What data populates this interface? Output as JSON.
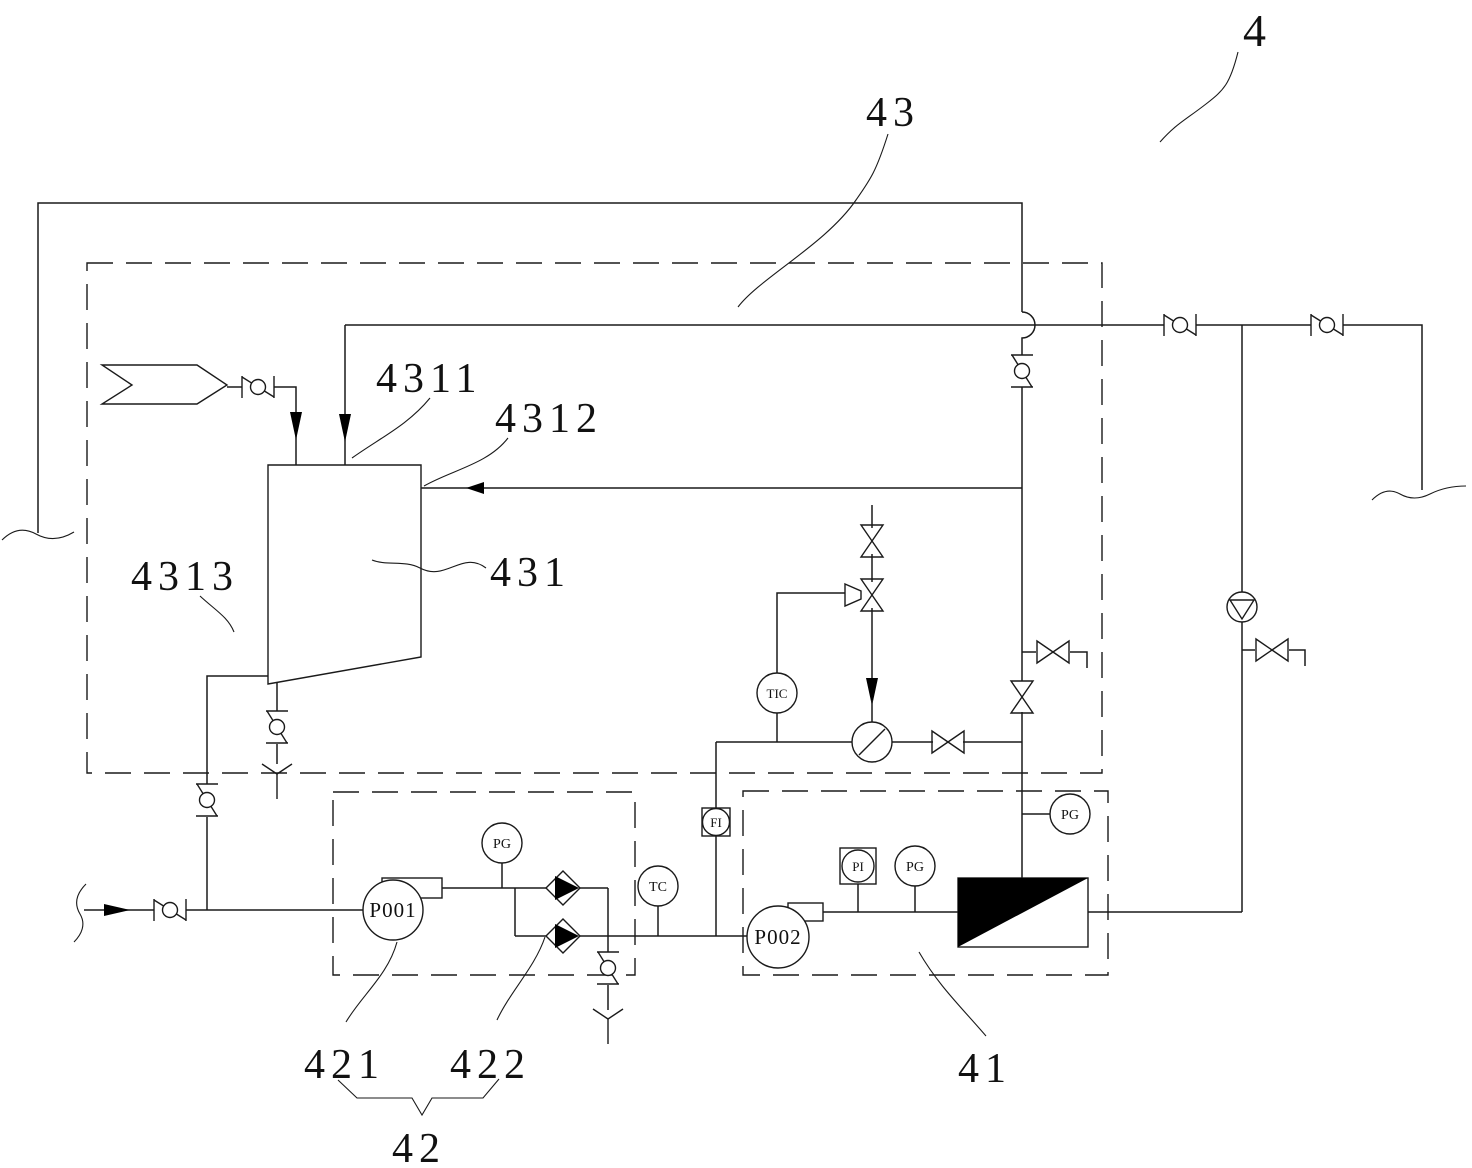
{
  "diagram": {
    "reference_labels": {
      "l4": "4",
      "l43": "43",
      "l4311": "4311",
      "l4312": "4312",
      "l431": "431",
      "l4313": "4313",
      "l421": "421",
      "l422": "422",
      "l42": "42",
      "l41": "41"
    },
    "equipment_tags": {
      "pump_feed": "P001",
      "pump_circulation": "P002"
    },
    "instrument_tags": {
      "pg_pump1": "PG",
      "tc_line": "TC",
      "fi_line": "FI",
      "tic_loop": "TIC",
      "pi_pump2": "PI",
      "pg_pump2": "PG",
      "pg_membrane": "PG"
    },
    "colors": {
      "line": "#1a1a1a",
      "fill_black": "#000000",
      "background": "#ffffff"
    }
  }
}
